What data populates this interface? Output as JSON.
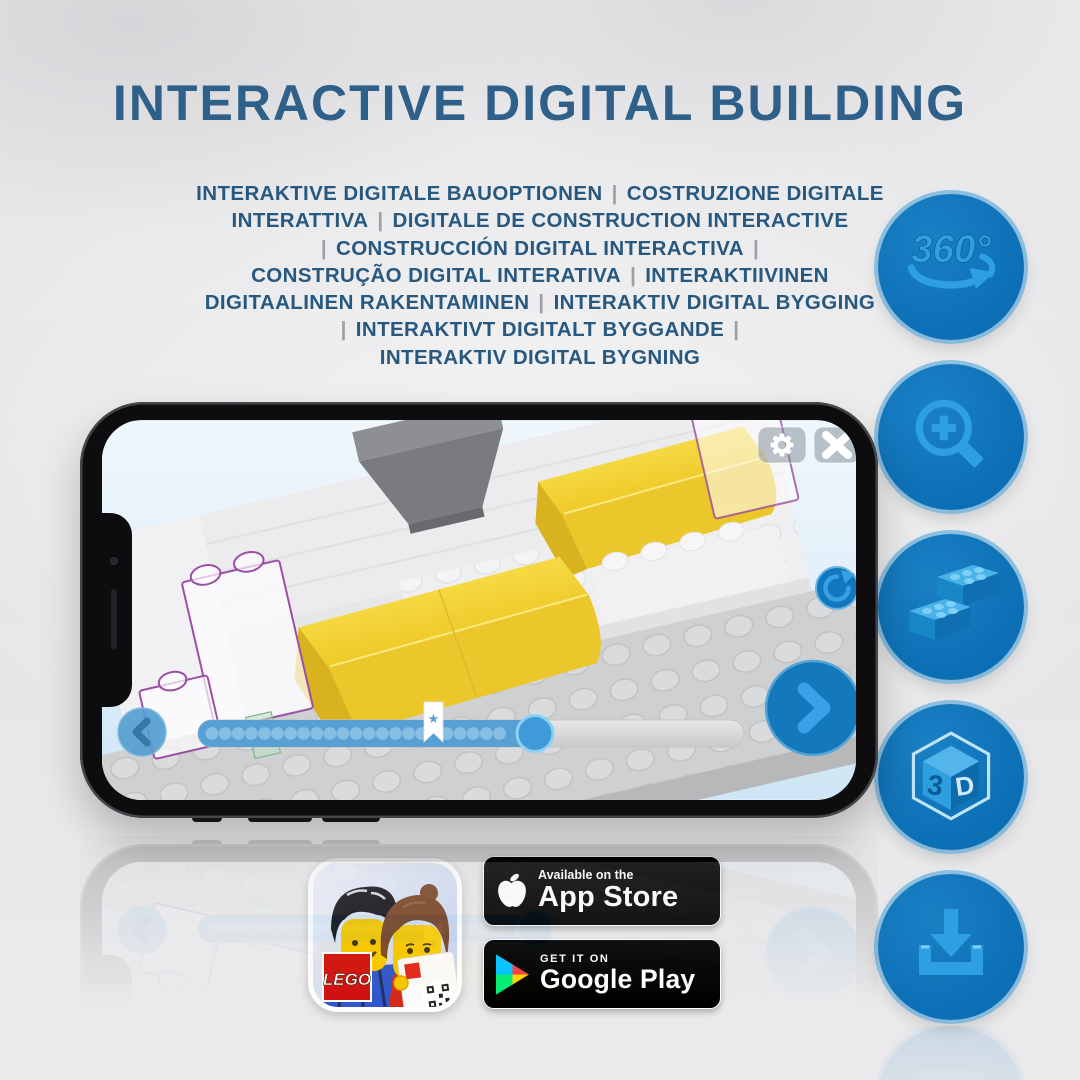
{
  "title": "INTERACTIVE DIGITAL BUILDING",
  "subtitle_lines": [
    "INTERAKTIVE DIGITALE BAUOPTIONEN | COSTRUZIONE DIGITALE",
    "INTERATTIVA | DIGITALE DE CONSTRUCTION INTERACTIVE",
    "| CONSTRUCCIÓN DIGITAL INTERACTIVA |",
    "CONSTRUÇÃO DIGITAL INTERATIVA | INTERAKTIIVINEN",
    "DIGITAALINEN RAKENTAMINEN | INTERAKTIV DIGITAL BYGGING",
    "| INTERAKTIVT DIGITALT BYGGANDE |",
    "INTERAKTIV DIGITAL BYGNING"
  ],
  "feature_icons": [
    {
      "name": "360-rotation-icon",
      "label": "360°"
    },
    {
      "name": "zoom-in-icon"
    },
    {
      "name": "lego-bricks-icon"
    },
    {
      "name": "3d-cube-icon",
      "left_face_label": "3",
      "right_face_label": "D"
    },
    {
      "name": "download-icon"
    }
  ],
  "phone_app": {
    "toolbar_icons": [
      "settings-gear",
      "close-x"
    ],
    "viewport_icons": [
      "rotate-reset"
    ],
    "nav": {
      "previous": "chevron-left",
      "next": "chevron-right"
    },
    "progress": {
      "dots_before_bookmark": 17,
      "dots_after_bookmark": 5,
      "bookmark_glyph": "★"
    }
  },
  "store_badges": {
    "app_store": {
      "logo": "apple-logo",
      "line1": "Available on the",
      "line2": "App Store"
    },
    "google_play": {
      "logo": "play-triangle",
      "line1": "GET IT ON",
      "line2": "Google Play"
    }
  },
  "app_icon": {
    "lego_logo_text": "LEGO"
  },
  "colors": {
    "title_blue": "#2e608a",
    "subtitle_blue": "#27587f",
    "circle_blue": "#0c6fb5",
    "glyph_blue": "#2d9fe2",
    "lego_red": "#d01012",
    "ghost_outline_purple": "#9a4fa2",
    "app_button_blue": "#1478bd"
  }
}
